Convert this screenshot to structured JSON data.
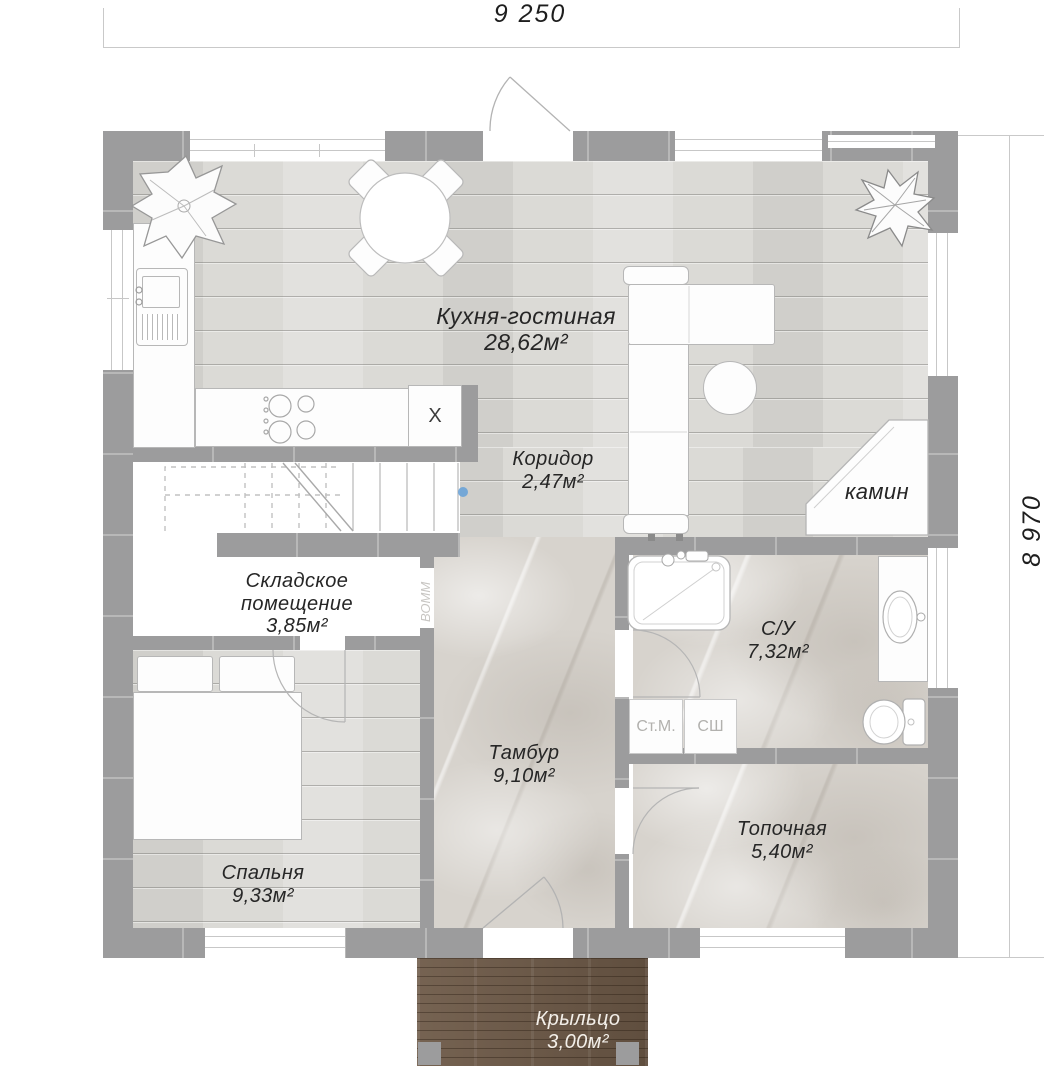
{
  "dimensions": {
    "width_top": "9 250",
    "height_right": "8 970"
  },
  "rooms": {
    "kitchen_living": {
      "name": "Кухня-гостиная",
      "area": "28,62м²"
    },
    "corridor": {
      "name": "Коридор",
      "area": "2,47м²"
    },
    "storage": {
      "name": "Складское помещение",
      "area": "3,85м²"
    },
    "bathroom": {
      "name": "С/У",
      "area": "7,32м²"
    },
    "tambour": {
      "name": "Тамбур",
      "area": "9,10м²"
    },
    "boiler": {
      "name": "Топочная",
      "area": "5,40м²"
    },
    "bedroom": {
      "name": "Спальня",
      "area": "9,33м²"
    },
    "porch": {
      "name": "Крыльцо",
      "area": "3,00м²"
    }
  },
  "fixtures": {
    "fireplace": "камин",
    "washing_machine": "Ст.М.",
    "dryer_cabinet": "СШ",
    "fridge_mark": "X"
  },
  "watermark": "ВОММ",
  "colors": {
    "wall": "#9c9c9d",
    "wood_floor": "#dbdad6",
    "tile_floor": "#d7d3cd",
    "deck": "#6d5947",
    "label_text": "#262626",
    "marker_dot": "#64a0d8"
  }
}
